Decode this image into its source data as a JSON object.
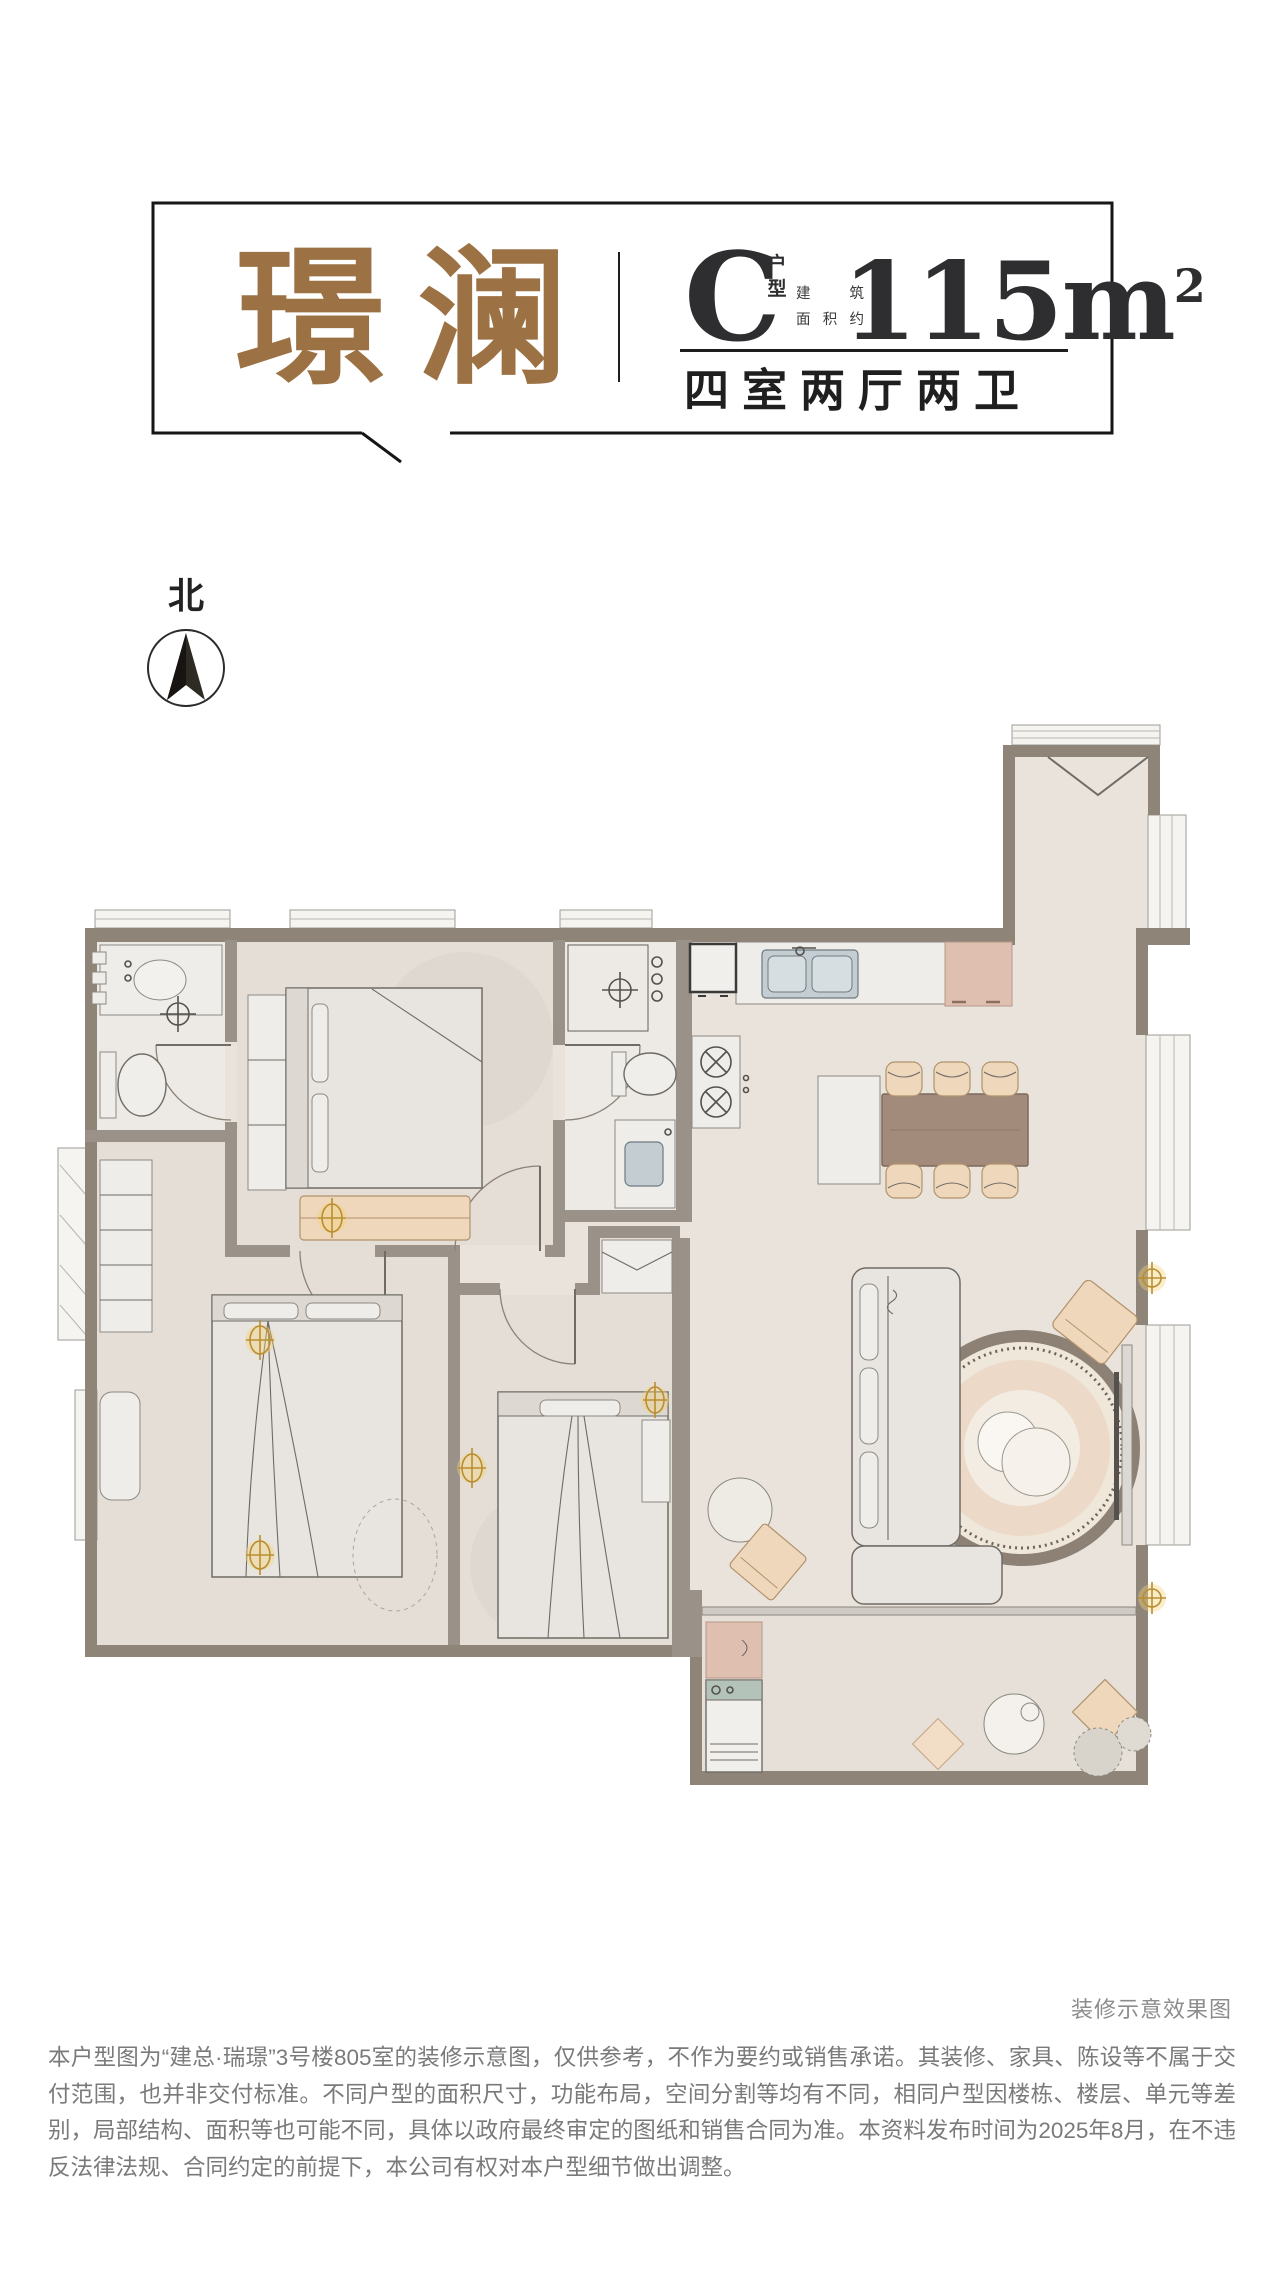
{
  "header": {
    "title": "璟澜",
    "title_color": "#9c7245",
    "unit_letter": "C",
    "unit_label": "户型",
    "unit_label_top": "户",
    "unit_label_bottom": "型",
    "area_caption_row1_a": "建",
    "area_caption_row1_b": "筑",
    "area_caption_row2_a": "面",
    "area_caption_row2_b": "积",
    "area_caption_row2_c": "约",
    "area_value": "115m",
    "area_sup": "2",
    "layout_desc": "四室两厅两卫"
  },
  "compass": {
    "label": "北"
  },
  "floor_plan": {
    "caption": "装修示意效果图",
    "wall_color": "#8e8478",
    "floor_color": "#e9e3db",
    "accent_tan": "#eed7bb",
    "accent_pink": "#debfb0",
    "rug_ring_color": "#8c8174"
  },
  "disclaimer": {
    "text": "本户型图为“建总·瑞璟”3号楼805室的装修示意图，仅供参考，不作为要约或销售承诺。其装修、家具、陈设等不属于交付范围，也并非交付标准。不同户型的面积尺寸，功能布局，空间分割等均有不同，相同户型因楼栋、楼层、单元等差别，局部结构、面积等也可能不同，具体以政府最终审定的图纸和销售合同为准。本资料发布时间为2025年8月，在不违反法律法规、合同约定的前提下，本公司有权对本户型细节做出调整。"
  }
}
